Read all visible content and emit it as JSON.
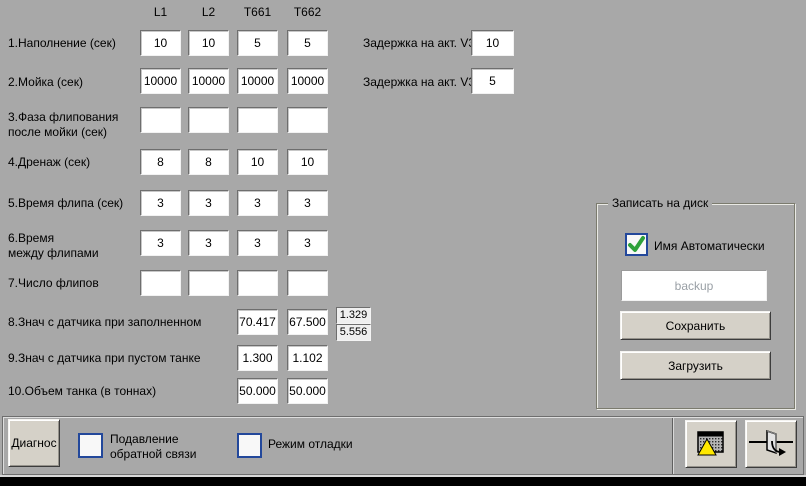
{
  "columns": [
    "L1",
    "L2",
    "T661",
    "T662"
  ],
  "grid": {
    "rows": [
      {
        "label": "1.Наполнение (сек)",
        "values": [
          "10",
          "10",
          "5",
          "5"
        ]
      },
      {
        "label": "2.Мойка (сек)",
        "values": [
          "10000",
          "10000",
          "10000",
          "10000"
        ]
      },
      {
        "label": "3.Фаза флипования\nпосле мойки (сек)",
        "values": [
          "",
          "",
          "",
          ""
        ]
      },
      {
        "label": "4.Дренаж (сек)",
        "values": [
          "8",
          "8",
          "10",
          "10"
        ]
      },
      {
        "label": "5.Время флипа (сек)",
        "values": [
          "3",
          "3",
          "3",
          "3"
        ]
      },
      {
        "label": "6.Время\nмежду флипами",
        "values": [
          "3",
          "3",
          "3",
          "3"
        ]
      },
      {
        "label": "7.Число флипов",
        "values": [
          "",
          "",
          "",
          ""
        ]
      },
      {
        "label": "8.Знач с датчика при заполненном",
        "values": [
          "70.417",
          "67.500"
        ],
        "extra": [
          "1.329",
          "5.556"
        ]
      },
      {
        "label": "9.Знач с датчика при пустом танке",
        "values": [
          "1.300",
          "1.102"
        ]
      },
      {
        "label": "10.Объем танка (в тоннах)",
        "values": [
          "50.000",
          "50.000"
        ]
      }
    ]
  },
  "delays": {
    "v36_label": "Задержка на акт. V36",
    "v36_value": "10",
    "v31_label": "Задержка на акт. V31",
    "v31_value": "5"
  },
  "save_panel": {
    "title": "Записать на диск",
    "auto_name_label": "Имя Автоматически",
    "auto_name_checked": true,
    "filename_placeholder": "backup",
    "save_button": "Сохранить",
    "load_button": "Загрузить"
  },
  "bottom_bar": {
    "diagnos_button": "Диагнос",
    "suppress_feedback_label": "Подавление\nобратной связи",
    "suppress_feedback_checked": false,
    "debug_mode_label": "Режим отладки",
    "debug_mode_checked": false
  },
  "colors": {
    "background": "#a8a8a8",
    "checkbox_border": "#23489b",
    "check_green": "#2ea13a",
    "warning_yellow": "#ffe800"
  }
}
